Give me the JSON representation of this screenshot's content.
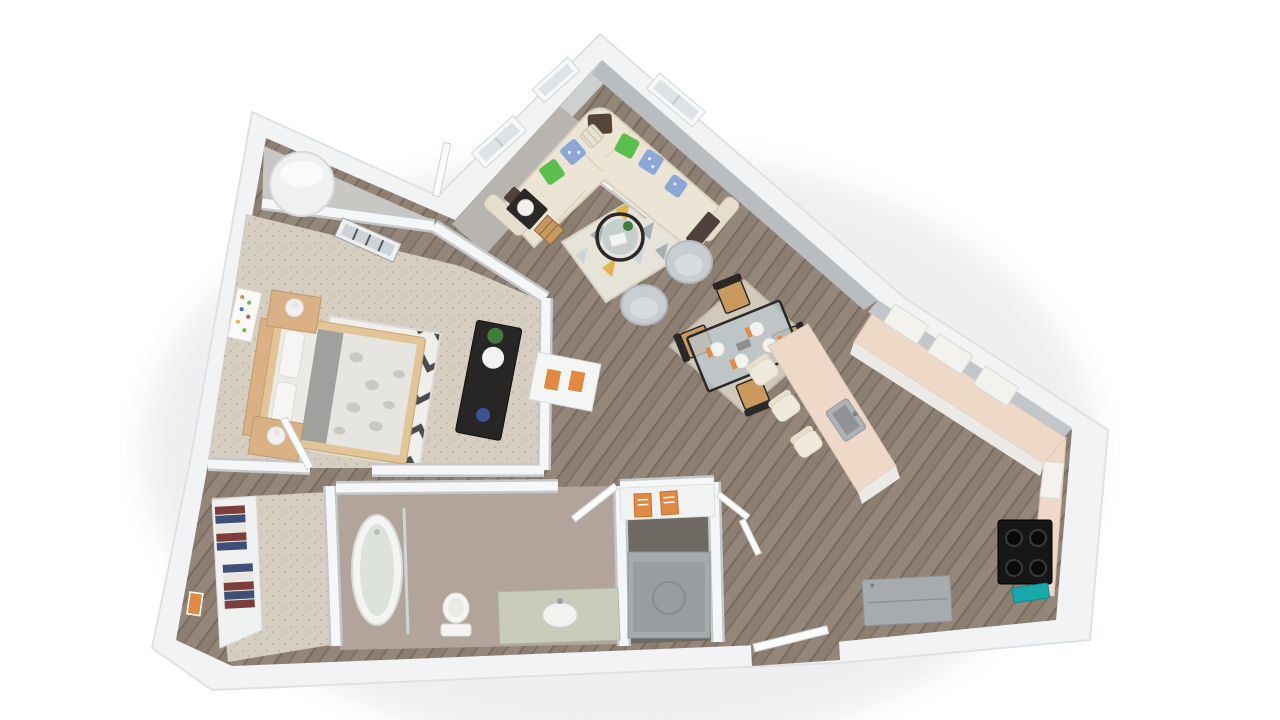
{
  "meta": {
    "type": "3d-floor-plan",
    "description": "Isometric 3D rendering of a one-bedroom, one-bath apartment floor plan viewed from above on a white background",
    "view": "bird's-eye isometric",
    "background": "#ffffff",
    "visible_text": "none"
  },
  "palette": {
    "wall": "#f2f3f4",
    "wall_edge": "#c4c8ca",
    "wall_face_light": "#ccd0d1",
    "wall_face_dark": "#b9bdbf",
    "wood": "#8c7e70",
    "carpet": "#d6cec1",
    "bath_floor": "#b3a49b",
    "entry_floor": "#b8b5b1",
    "laundry_floor": "#6e6a63",
    "utility_floor": "#c9c7c4",
    "counter": "#eed9c9",
    "cabinet_face": "#eceae6",
    "sofa": "#ece4d4",
    "sofa_trim": "#d9d0bd",
    "pillow_green": "#5abf4c",
    "pillow_blue": "#8aa7d8",
    "throw_brown": "#50423a",
    "rug_living": "#e6e3d9",
    "rug_tri_gray": "#a6b0b4",
    "rug_tri_yellow": "#e3b44a",
    "rug_dining": "#d1c9bc",
    "barrel_chair": "#c7cdd1",
    "frame_black": "#2a2928",
    "wood_tan": "#d9b184",
    "seat_wood": "#c9995e",
    "bed_linen": "#eceae6",
    "bed_gray": "#a0a09e",
    "chevron_dark": "#4c4c4a",
    "dresser_black": "#272625",
    "appliance_gray": "#a6abad",
    "cooktop_black": "#171616",
    "teal_accent": "#17a8ac",
    "vanity_green": "#c8ccba",
    "fixture_white": "#f4f5f3",
    "clothes_red": "#7c3d3b",
    "clothes_navy": "#3f5078",
    "accent_orange": "#e28a43",
    "plant_green": "#3f7d3a",
    "glass_blue": "#b9c5c8"
  },
  "rooms": [
    {
      "id": "living-room",
      "name": "Living Room",
      "floor": "hardwood",
      "furniture": [
        "L-shaped cream sectional sofa",
        "green accent pillows",
        "blue patterned pillows",
        "dark brown arm trays",
        "round black-frame coffee table with plant and book",
        "geometric triangle area rug",
        "two gray barrel chairs",
        "black side table with white ball lamp",
        "woven wood accent cube"
      ]
    },
    {
      "id": "dining-area",
      "name": "Dining Area",
      "floor": "hardwood",
      "furniture": [
        "glass-top dining table with black frame",
        "four black chairs with wood seats",
        "four white place settings with orange napkins",
        "beige area rug"
      ]
    },
    {
      "id": "kitchen",
      "name": "Kitchen",
      "floor": "hardwood",
      "furniture": [
        "L-shaped peach counter with breakfast peninsula",
        "three cream bar stools",
        "gray undermount sink",
        "black four-burner cooktop",
        "teal accent mat",
        "gray refrigerator",
        "white upper cabinets"
      ]
    },
    {
      "id": "bedroom",
      "name": "Bedroom",
      "floor": "carpet",
      "furniture": [
        "wood-frame bed with white pillows, gray runner and gray floral duvet",
        "black and white chevron rug",
        "two wood nightstands with white cylinder lamps",
        "black dresser with globe lamp, plant and blue decor",
        "colorful dot wall art"
      ]
    },
    {
      "id": "walk-in-closet",
      "name": "Walk-in Closet",
      "floor": "carpet",
      "furniture": [
        "shelving with folded clothes in red, navy and white",
        "orange wall art"
      ]
    },
    {
      "id": "bathroom",
      "name": "Bathroom",
      "floor": "tile",
      "furniture": [
        "oval bathtub with glass panel",
        "toilet",
        "green-topped vanity with white sink"
      ]
    },
    {
      "id": "laundry-closet",
      "name": "Laundry Closet",
      "floor": "tile",
      "furniture": [
        "gray washer-dryer unit",
        "shelf with two orange detergent boxes",
        "bifold doors"
      ]
    },
    {
      "id": "utility-closet",
      "name": "Utility Closet",
      "floor": "concrete",
      "furniture": [
        "white cylindrical water heater"
      ]
    },
    {
      "id": "entry",
      "name": "Entry",
      "floor": "gray tile",
      "furniture": [
        "open white entry door",
        "hall niche with two orange books"
      ]
    }
  ],
  "features": [
    "angled exterior walls",
    "windows on upper walls",
    "open-plan living, dining and kitchen",
    "entry opening in bottom wall"
  ]
}
